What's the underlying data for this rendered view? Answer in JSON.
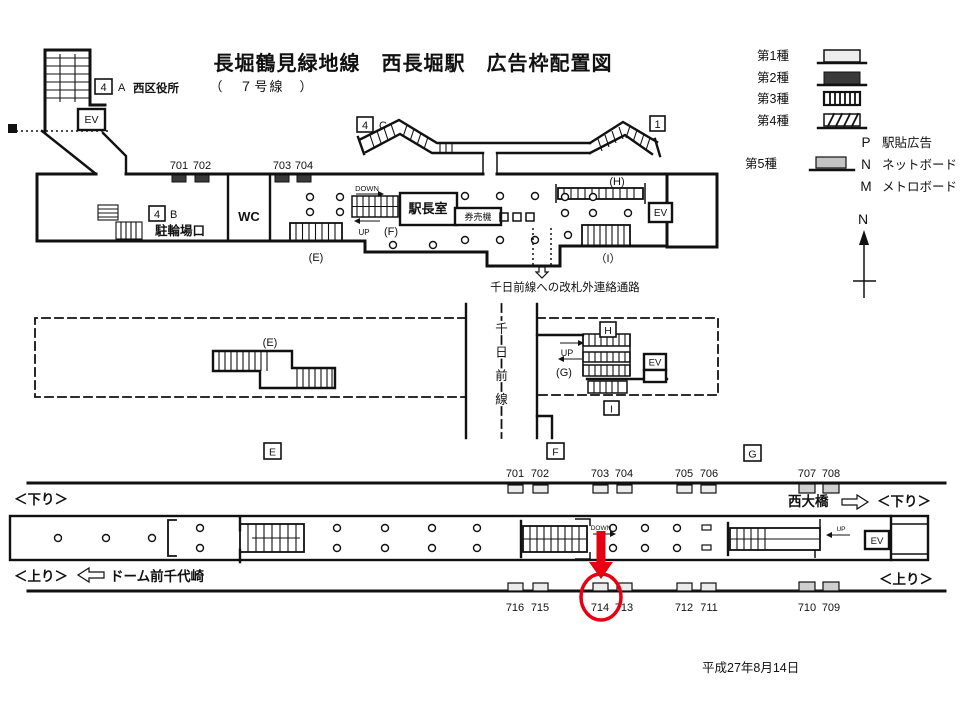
{
  "title": {
    "main": "長堀鶴見緑地線　西長堀駅　広告枠配置図",
    "sub": "（　７号線　）"
  },
  "legend": {
    "type1": "第1種",
    "type2": "第2種",
    "type3": "第3種",
    "type4": "第4種",
    "type5": "第5種",
    "p_key": "P",
    "p_label": "駅貼広告",
    "n_key": "N",
    "n_label": "ネットボード",
    "m_key": "M",
    "m_label": "メトロボード",
    "compass_n": "N"
  },
  "concourse": {
    "exit4_num": "4",
    "exit_a": "A",
    "ward_office": "西区役所",
    "ev_top": "EV",
    "exit_b": "B",
    "bicycle": "駐輪場口",
    "wc": "WC",
    "exit_c": "C",
    "exit1": "1",
    "office": "駅長室",
    "ticket_machine": "券売機",
    "down": "DOWN",
    "up": "UP",
    "e": "(E)",
    "f": "(F)",
    "h": "(H)",
    "i": "（I）",
    "ev_right": "EV",
    "ads": [
      "701",
      "702",
      "703",
      "704"
    ],
    "passage": "千日前線への改札外連絡通路"
  },
  "mezzanine": {
    "e": "(E)",
    "g": "(G)",
    "up": "UP",
    "ev": "EV",
    "line_name": "千日前線",
    "box_e": "E",
    "box_f": "F",
    "box_g": "G",
    "box_h": "H",
    "box_i": "I"
  },
  "platform": {
    "upper_ads": [
      "701",
      "702",
      "703",
      "704",
      "705",
      "706",
      "707",
      "708"
    ],
    "lower_ads": [
      "716",
      "715",
      "714",
      "713",
      "712",
      "711",
      "710",
      "709"
    ],
    "down_left": "＜下り＞",
    "down_right": "＜下り＞",
    "up_left": "＜上り＞",
    "up_right": "＜上り＞",
    "next_right": "西大橋",
    "next_left": "ドーム前千代崎",
    "down": "DOWN",
    "up": "UP",
    "ev": "EV",
    "highlighted_ad": "714"
  },
  "date": "平成27年8月14日",
  "colors": {
    "highlight_red": "#e60012",
    "ink": "#111111",
    "ad_type1": "#ececec",
    "ad_type2": "#3a3a3a",
    "ad_type5": "#c4c4c4"
  }
}
